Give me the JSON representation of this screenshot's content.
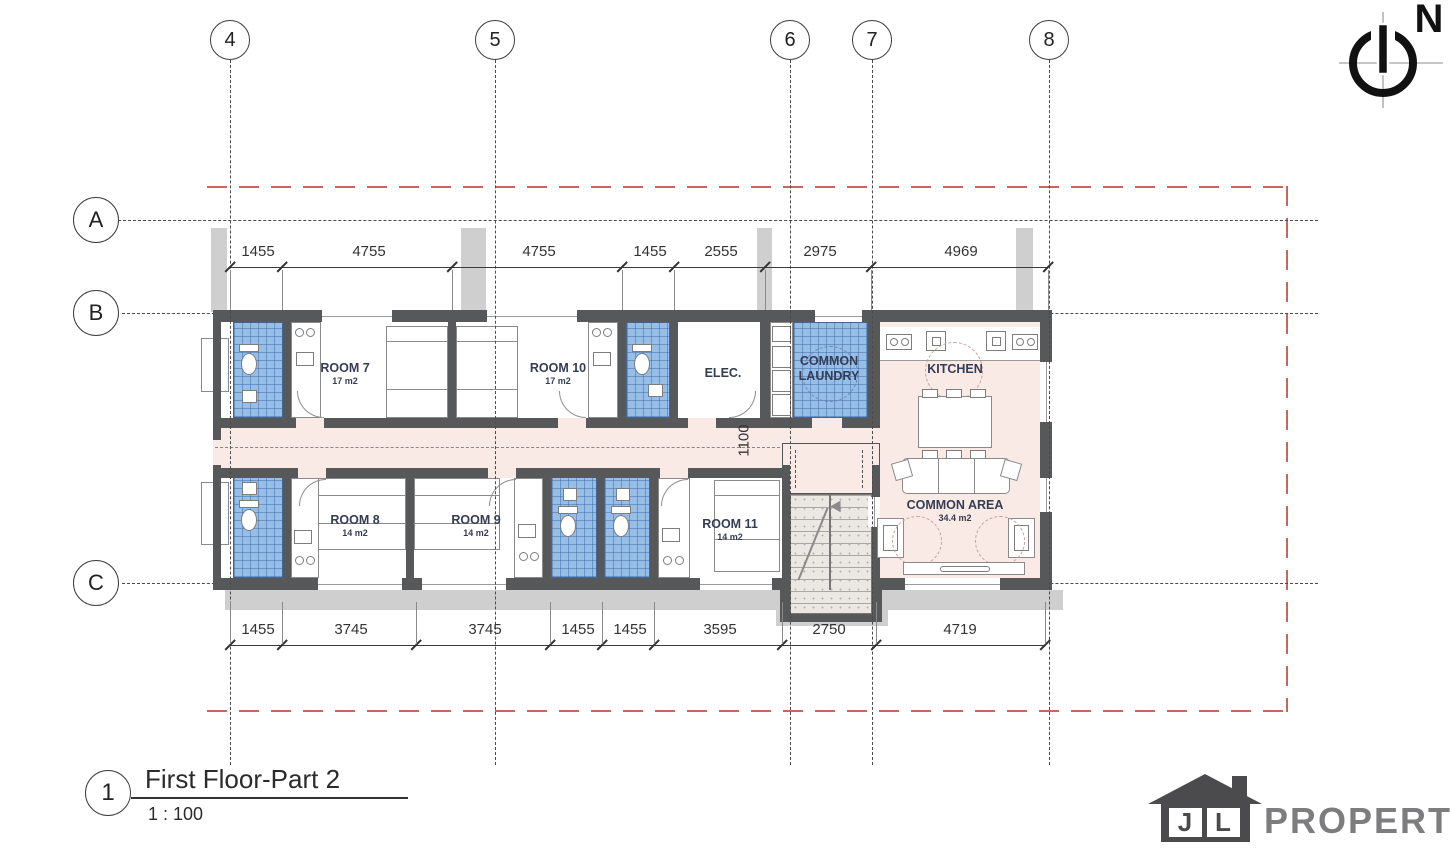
{
  "drawing": {
    "title": "First Floor-Part 2",
    "scale": "1 : 100",
    "detail_number": "1",
    "north": "N"
  },
  "grid": {
    "columns": [
      "4",
      "5",
      "6",
      "7",
      "8"
    ],
    "rows": [
      "A",
      "B",
      "C"
    ]
  },
  "dims": {
    "top": [
      "1455",
      "4755",
      "4755",
      "1455",
      "2555",
      "2975",
      "4969"
    ],
    "bottom": [
      "1455",
      "3745",
      "3745",
      "1455",
      "1455",
      "3595",
      "2750",
      "4719"
    ],
    "corridor": "1100"
  },
  "rooms": [
    {
      "name": "ROOM 7",
      "area": "17 m2"
    },
    {
      "name": "ROOM 10",
      "area": "17 m2"
    },
    {
      "name": "ELEC.",
      "area": ""
    },
    {
      "name": "COMMON LAUNDRY",
      "area": ""
    },
    {
      "name": "KITCHEN",
      "area": ""
    },
    {
      "name": "ROOM 8",
      "area": "14 m2"
    },
    {
      "name": "ROOM 9",
      "area": "14 m2"
    },
    {
      "name": "ROOM 11",
      "area": "14 m2"
    },
    {
      "name": "COMMON AREA",
      "area": "34.4 m2"
    }
  ],
  "logo": {
    "letter_j": "J",
    "letter_l": "L",
    "word": "PROPERTY"
  },
  "colors": {
    "wall_gray": "#57585a",
    "bathroom_blue": "#97bee7",
    "zone_pink": "#f9eae6",
    "boundary_red": "#c4685c"
  }
}
